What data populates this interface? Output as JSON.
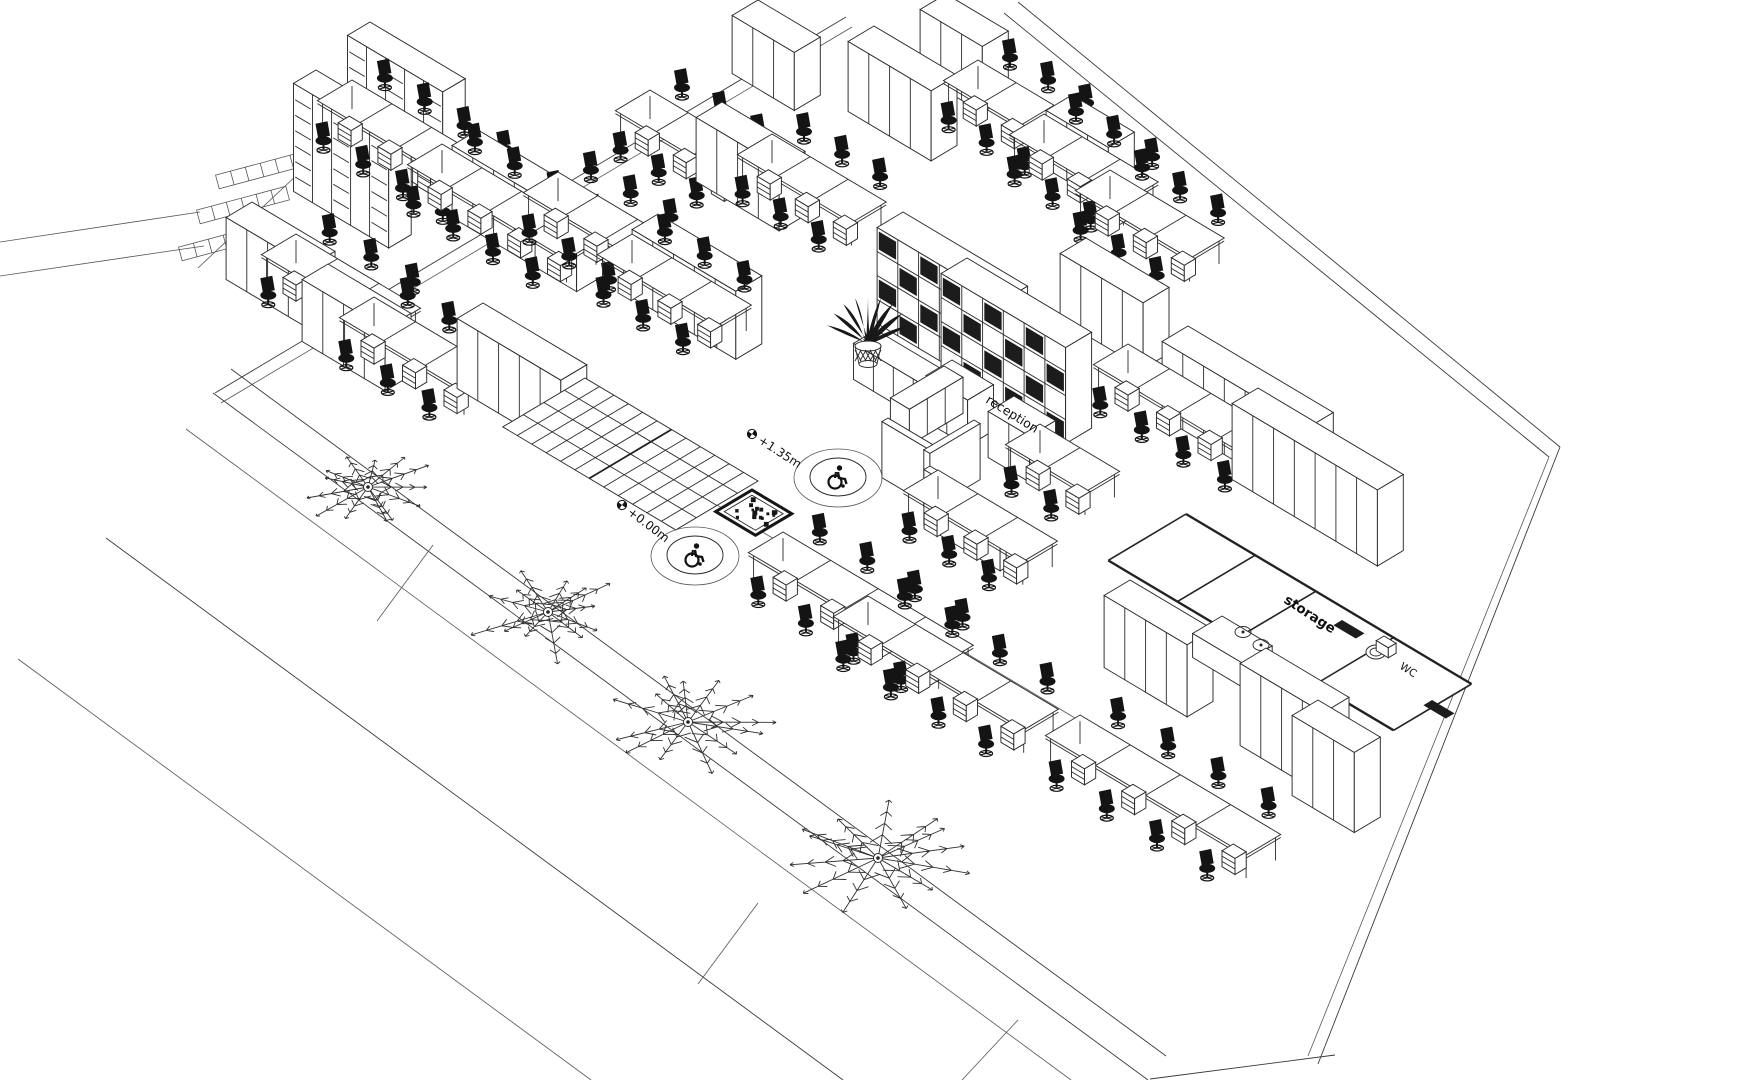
{
  "scene": {
    "type": "axonometric-office-floor-plan",
    "paper": "#ffffff",
    "ink": "#2a2a2a",
    "site_line": "#3a3a3a",
    "chair_color": "#141414",
    "dark_fill": "#1c1c1c"
  },
  "labels": {
    "reception": "reception",
    "level_upper": "+1.35m",
    "level_ground": "+0.00m",
    "storage": "storage",
    "wc": "WC"
  },
  "icons": {
    "wheelchair": "wheelchair-icon",
    "level_marker": "level-marker-icon",
    "palm": "palm-tree",
    "plant": "potted-plant-icon",
    "elevator": "elevator-shaft-icon",
    "stairs": "stairs-icon"
  }
}
